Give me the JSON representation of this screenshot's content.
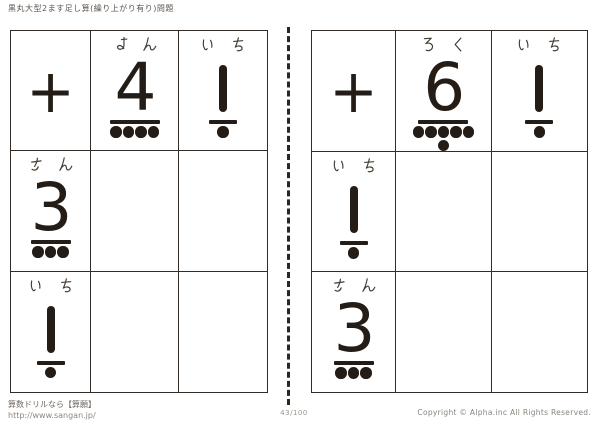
{
  "header": {
    "title": "黒丸大型2ます足し算(繰り上がり有り)問題"
  },
  "worksheet": {
    "tables": [
      {
        "id": "left",
        "operator": "+",
        "col_headers": [
          {
            "value": 4,
            "reading": "よん"
          },
          {
            "value": 1,
            "reading": "いち"
          }
        ],
        "row_headers": [
          {
            "value": 3,
            "reading": "さん"
          },
          {
            "value": 1,
            "reading": "いち"
          }
        ]
      },
      {
        "id": "right",
        "operator": "+",
        "col_headers": [
          {
            "value": 6,
            "reading": "ろく"
          },
          {
            "value": 1,
            "reading": "いち"
          }
        ],
        "row_headers": [
          {
            "value": 1,
            "reading": "いち"
          },
          {
            "value": 3,
            "reading": "さん"
          }
        ]
      }
    ]
  },
  "footer": {
    "site_line": "算数ドリルなら【算願】",
    "url": "http://www.sangan.jp/",
    "page_number": "43/100",
    "copyright": "Copyright © Alpha.inc All Rights Reserved."
  },
  "colors": {
    "ink": "#241c16",
    "grid_line": "#332b26",
    "muted_text": "#8d8781"
  }
}
